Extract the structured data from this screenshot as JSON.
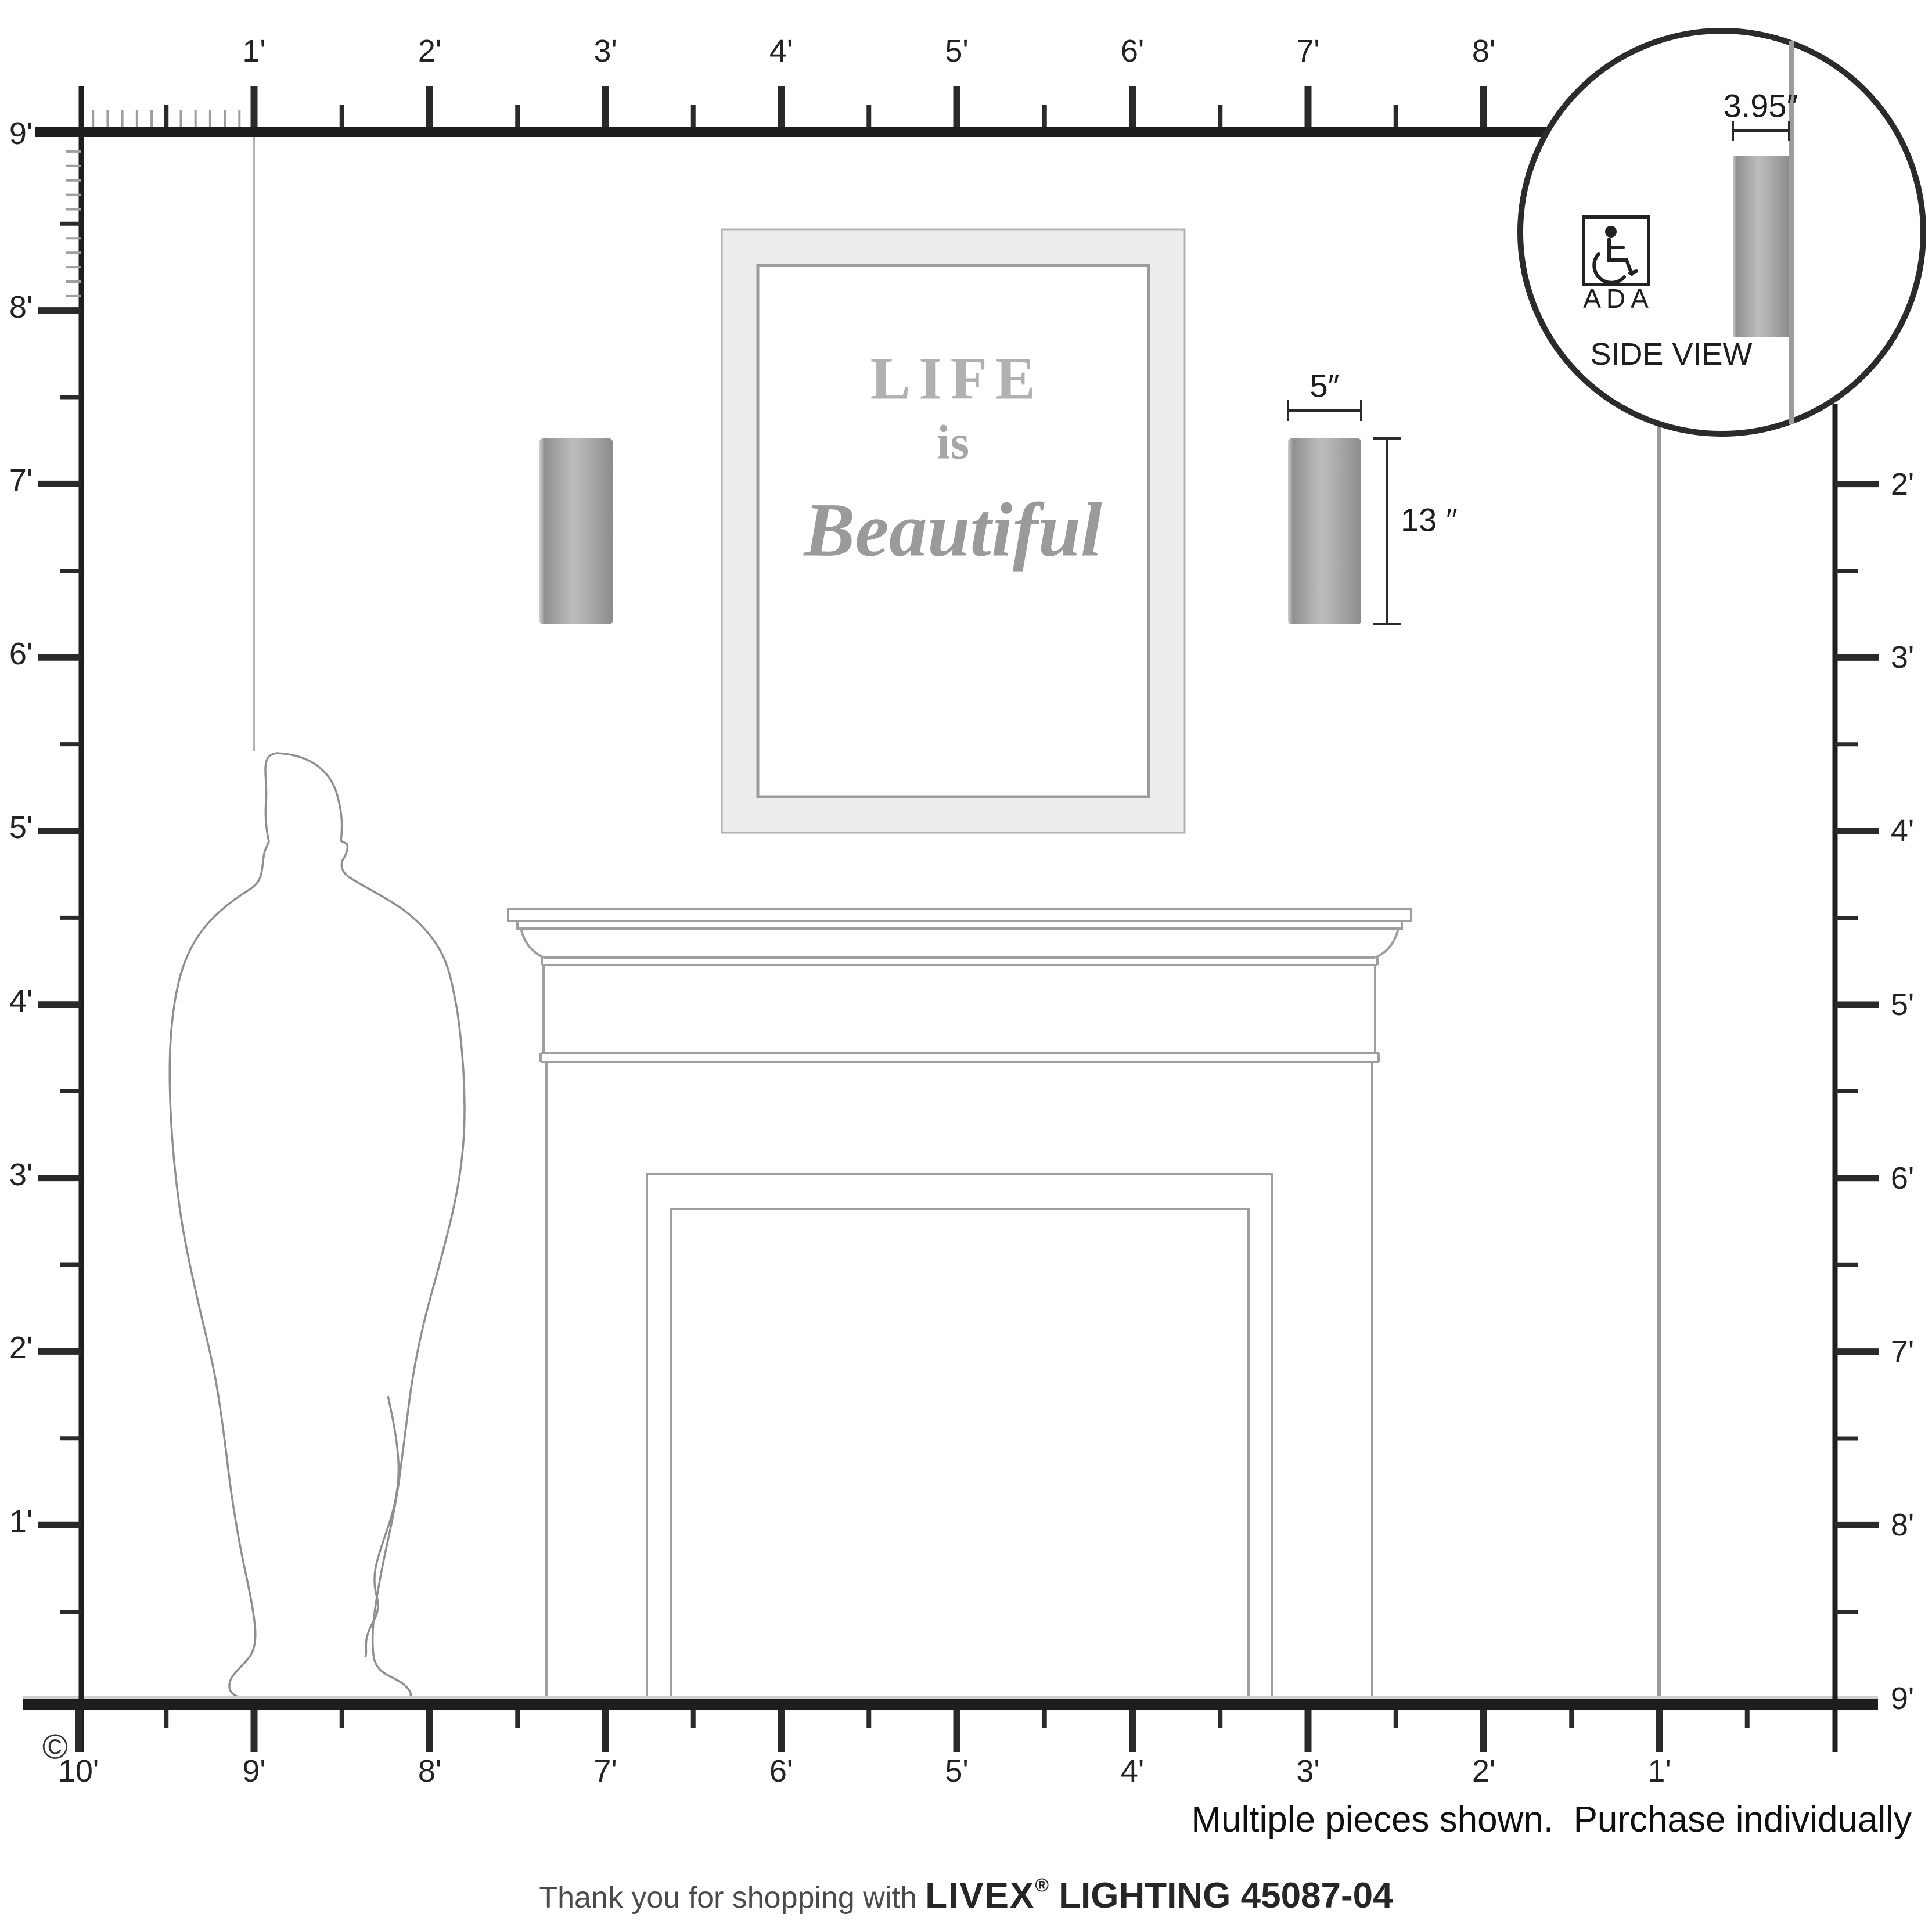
{
  "rulers": {
    "top": {
      "labels": [
        "1'",
        "2'",
        "3'",
        "4'",
        "5'",
        "6'",
        "7'",
        "8'"
      ]
    },
    "bottom": {
      "labels": [
        "10'",
        "9'",
        "8'",
        "7'",
        "6'",
        "5'",
        "4'",
        "3'",
        "2'",
        "1'"
      ]
    },
    "left": {
      "labels": [
        "9'",
        "8'",
        "7'",
        "6'",
        "5'",
        "4'",
        "3'",
        "2'",
        "1'"
      ]
    },
    "right": {
      "labels": [
        "2'",
        "3'",
        "4'",
        "5'",
        "6'",
        "7'",
        "8'",
        "9'"
      ]
    }
  },
  "dimensions": {
    "sconce_width": "5″",
    "sconce_height": "13 ″",
    "sconce_depth": "3.95″"
  },
  "inset": {
    "ada_label": "ADA",
    "ada_icon": "wheelchair-icon",
    "caption": "SIDE VIEW"
  },
  "artwork": {
    "line1": "LIFE",
    "line2": "is",
    "line3": "Beautiful"
  },
  "footer": {
    "copyright": "©",
    "note": "Multiple pieces shown.  Purchase individually",
    "thanks_prefix": "Thank you for shopping with ",
    "brand": "LIVEX",
    "reg": "®",
    "product": " LIGHTING 45087-04"
  },
  "colors": {
    "line_dark": "#232323",
    "line_gray": "#9e9e9e",
    "sconce_edge": "#8e8e8e",
    "sconce_highlight": "#bdbdbd",
    "frame_fill": "#ededed",
    "art_text": "#a7a7a7"
  }
}
